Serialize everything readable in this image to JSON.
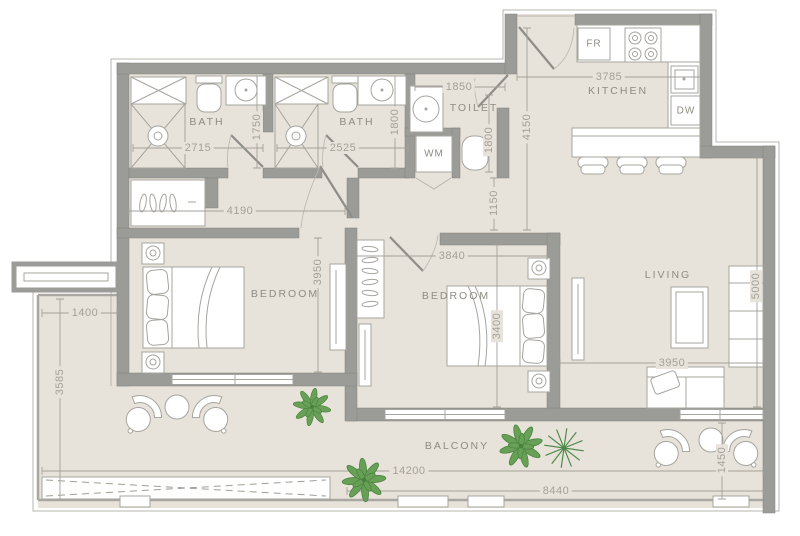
{
  "colors": {
    "floor": "#e8e3da",
    "wall": "#9b9b97",
    "lineA": "#a6a49e",
    "dim": "#a3a098",
    "text": "#8f8b84",
    "plant": "#68a058"
  },
  "rooms": {
    "bath": "BATH",
    "toilet": "TOILET",
    "kitchen": "KITCHEN",
    "bedroom": "BEDROOM",
    "living": "LIVING",
    "balcony": "BALCONY"
  },
  "appliances": {
    "fridge": "FR",
    "dishwasher": "DW",
    "washing_machine": "WM"
  },
  "dimensions": {
    "bath1_width": "2715",
    "bath1_depth": "1750",
    "bath2_width": "2525",
    "bath2_depth": "1800",
    "toilet_width": "1850",
    "toilet_depth": "1800",
    "hall_length": "4150",
    "hall_width": "1150",
    "corridor_length": "4190",
    "bedroom1_depth": "3950",
    "bedroom2_width": "3840",
    "bedroom2_depth": "3400",
    "living_depth": "5000",
    "kitchen_width": "3785",
    "living_width": "3950",
    "balcony_left_width": "1400",
    "balcony_left_depth": "3585",
    "balcony_total_width": "14200",
    "balcony_right_width": "8440",
    "balcony_right_depth": "1450"
  }
}
